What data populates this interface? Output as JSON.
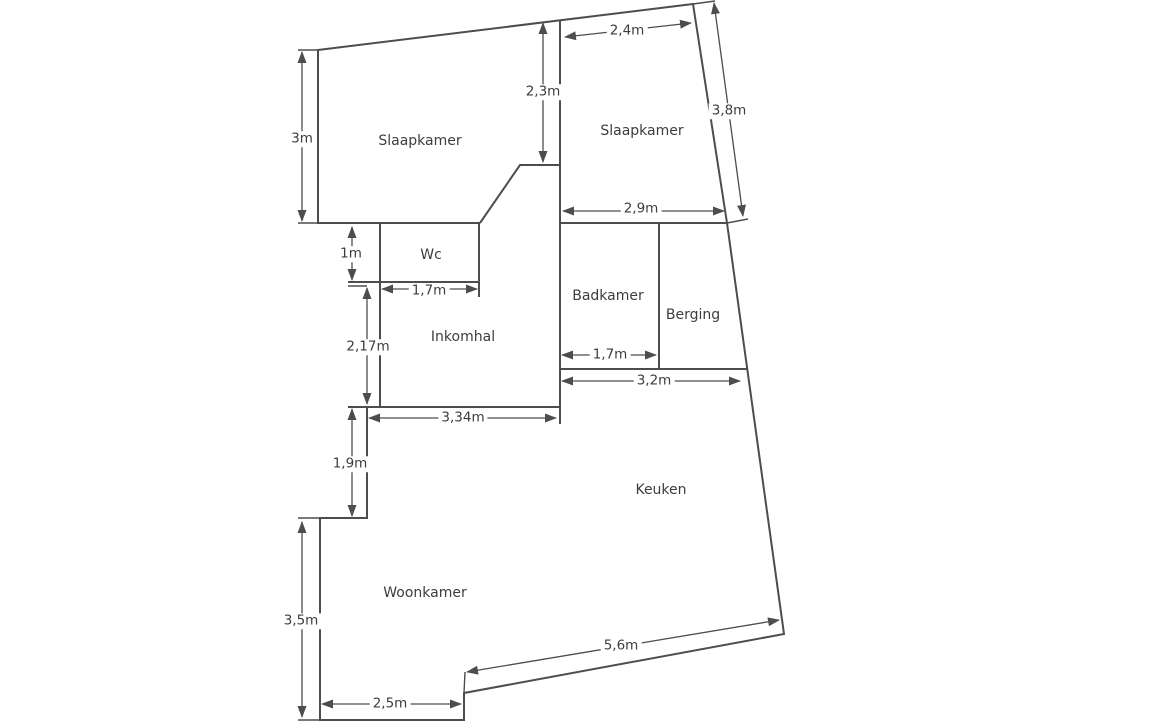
{
  "plan": {
    "type": "floor-plan",
    "language": "nl",
    "rooms": {
      "slaapkamer_left": "Slaapkamer",
      "slaapkamer_right": "Slaapkamer",
      "wc": "Wc",
      "inkomhal": "Inkomhal",
      "badkamer": "Badkamer",
      "berging": "Berging",
      "keuken": "Keuken",
      "woonkamer": "Woonkamer"
    },
    "dimensions": {
      "slaapkamer_left_height": "3m",
      "slaapkamer_left_depth": "2,3m",
      "slaapkamer_right_width_top": "2,4m",
      "slaapkamer_right_side": "3,8m",
      "slaapkamer_right_width_bottom": "2,9m",
      "wc_height": "1m",
      "wc_width": "1,7m",
      "inkomhal_height": "2,17m",
      "inkomhal_width": "3,34m",
      "badkamer_width": "1,7m",
      "badkamer_berging_width": "3,2m",
      "woonkamer_step_height": "1,9m",
      "woonkamer_height": "3,5m",
      "woonkamer_width_bottom": "2,5m",
      "keuken_diagonal_wall": "5,6m"
    },
    "colors": {
      "wall_line": "#4d4d4d",
      "dimension_line": "#4d4d4d",
      "text": "#3d3d3d",
      "background": "#ffffff"
    }
  }
}
